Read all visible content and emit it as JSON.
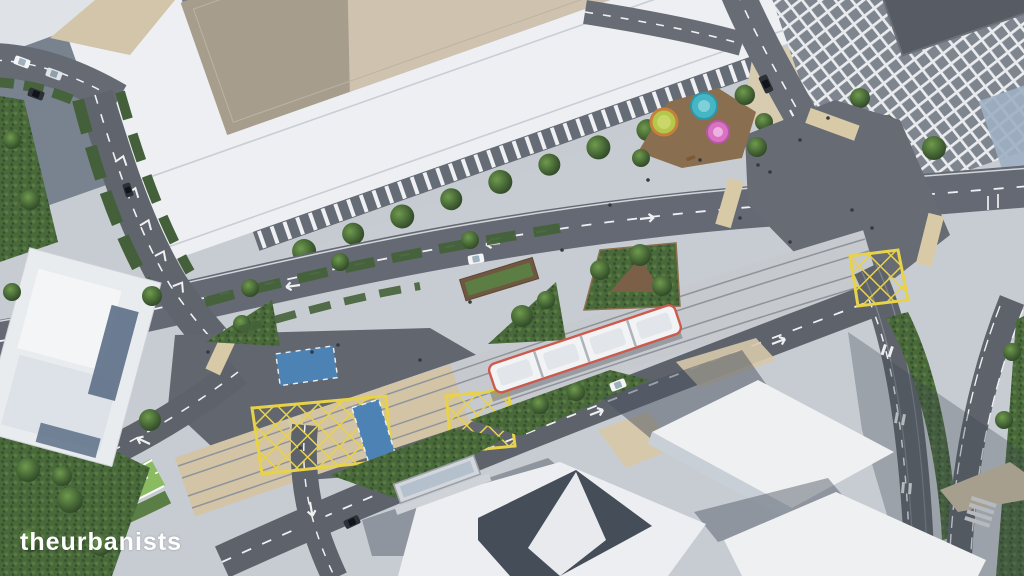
{
  "watermark": {
    "text": "theurbanists"
  },
  "scene": {
    "type": "aerial-3d-architectural-render",
    "subject": "bird's-eye visualisation of an urban street redesign with tram corridor, box junctions, cycle crossings and new public realm",
    "objects": [
      "long-courtyard-building",
      "grid-facade-tower",
      "white-massing-blocks",
      "terraced-building",
      "tram",
      "tram-corridor",
      "upper-street",
      "side-streets",
      "yellow-box-junctions",
      "blue-cycle-crossings",
      "green-cycle-track",
      "playground-plaza",
      "planted-triangles",
      "street-trees",
      "hedges",
      "pedestrians",
      "cars",
      "tram-shelter",
      "zebra-crossing",
      "tan-crossing-strips"
    ],
    "palette": {
      "pavement": "#c7ccd2",
      "asphalt": "#60656d",
      "marking_white": "#eef0f2",
      "grass_green": "#4e7040",
      "cycle_track_green": "#8abb60",
      "box_junction_yellow": "#e8d24a",
      "cycle_crossing_blue": "#4d82b5",
      "building_white": "#eef0f2",
      "courtyard_roof_beige": "#cfc3b0",
      "tower_roof_grey": "#575c64",
      "tram_accent_red": "#cc5a4d",
      "plaza_tan": "#d8caa6",
      "shadow_blue_grey": "#8e97a5",
      "play_circle_green": "#b5c84b",
      "play_circle_teal": "#45b6c6",
      "play_circle_pink": "#d873c4"
    }
  }
}
